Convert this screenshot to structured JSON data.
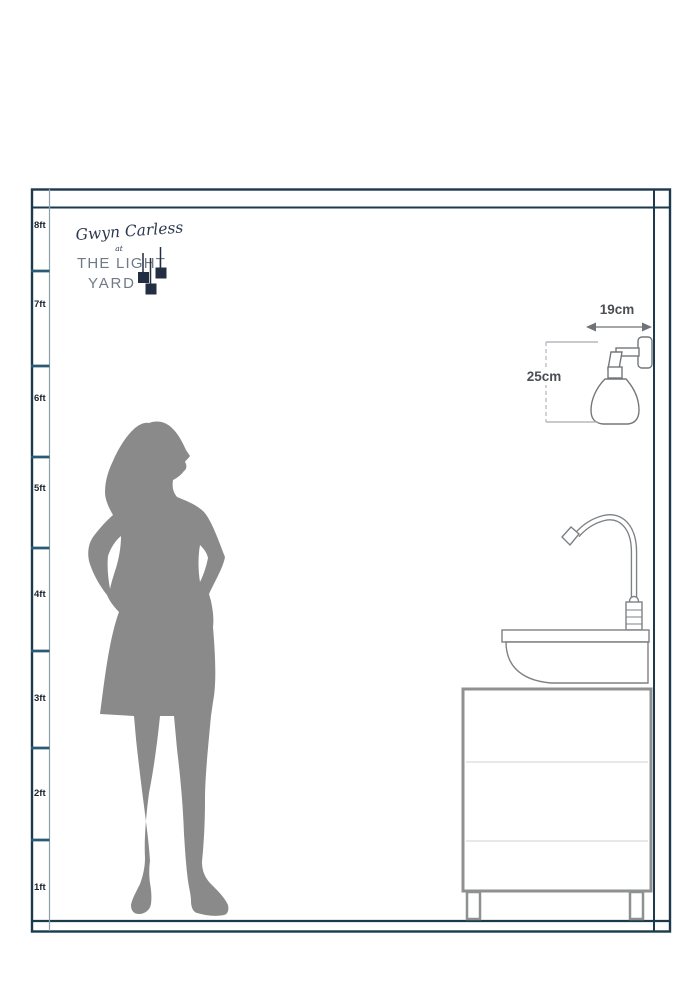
{
  "brand": {
    "script_name": "Gwyn Carless",
    "at": "at",
    "line1": "THE LIGHT",
    "line2": "YARD"
  },
  "ruler": {
    "unit": "ft",
    "labels": [
      "8ft",
      "7ft",
      "6ft",
      "5ft",
      "4ft",
      "3ft",
      "2ft",
      "1ft"
    ]
  },
  "dimensions": {
    "width_label": "19cm",
    "height_label": "25cm"
  },
  "colors": {
    "frame": "#1d3a4c",
    "tick": "#2a5a74",
    "ruler_divider": "#8aa0ab",
    "silhouette": "#8a8a8a",
    "logo_dark": "#232e42",
    "logo_gray": "#6f7a86",
    "fixture_outline": "#73777b",
    "furniture_outline": "#7e8184",
    "cabinet_border": "#8e9091",
    "dimension_text": "#4b4f54",
    "arrow": "#85898c"
  }
}
